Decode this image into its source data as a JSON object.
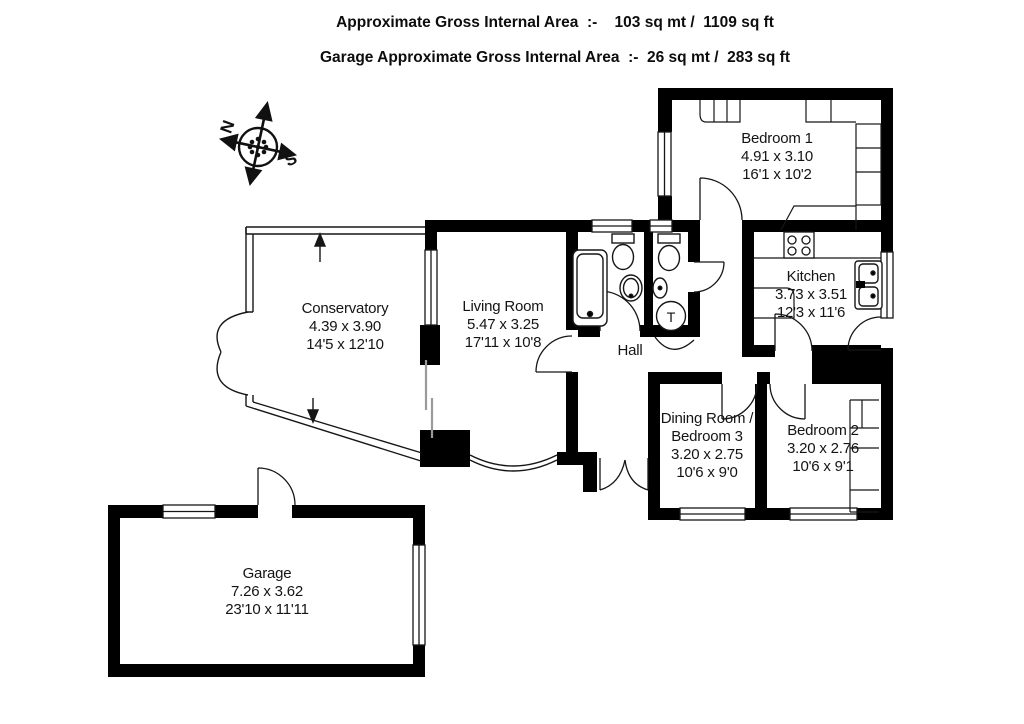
{
  "header": {
    "line1": "Approximate Gross Internal Area  :-    103 sq mt /  1109 sq ft",
    "line2": "Garage Approximate Gross Internal Area  :-  26 sq mt /  283 sq ft"
  },
  "compass": {
    "north": "N",
    "south": "S"
  },
  "rooms": {
    "bedroom1": {
      "name": "Bedroom 1",
      "metric": "4.91 x 3.10",
      "imperial": "16'1 x 10'2"
    },
    "kitchen": {
      "name": "Kitchen",
      "metric": "3.73 x 3.51",
      "imperial": "12'3 x 11'6"
    },
    "conservatory": {
      "name": "Conservatory",
      "metric": "4.39 x 3.90",
      "imperial": "14'5 x 12'10"
    },
    "living_room": {
      "name": "Living Room",
      "metric": "5.47 x 3.25",
      "imperial": "17'11 x 10'8"
    },
    "hall": {
      "name": "Hall"
    },
    "dining_bedroom3": {
      "name_line1": "Dining Room /",
      "name_line2": "Bedroom 3",
      "metric": "3.20 x 2.75",
      "imperial": "10'6 x 9'0"
    },
    "bedroom2": {
      "name": "Bedroom 2",
      "metric": "3.20 x 2.76",
      "imperial": "10'6 x 9'1"
    },
    "garage": {
      "name": "Garage",
      "metric": "7.26 x 3.62",
      "imperial": "23'10 x 11'11"
    }
  },
  "fixtures": {
    "tank_label": "T"
  },
  "colors": {
    "wall": "#000000",
    "line": "#161616",
    "gray": "#9a9a9a"
  }
}
